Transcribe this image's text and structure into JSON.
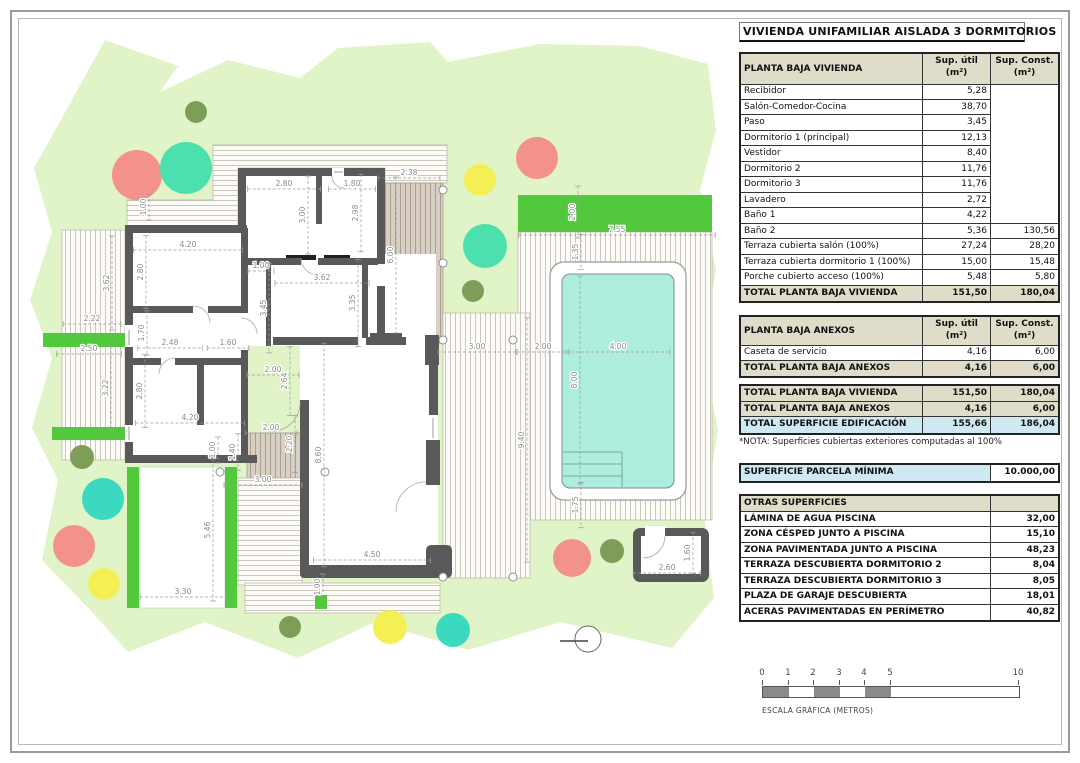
{
  "title": "VIVIENDA UNIFAMILIAR AISLADA 3 DORMITORIOS",
  "columns": {
    "util": "Sup. útil\n(m²)",
    "const": "Sup. Const.\n(m²)"
  },
  "tables": {
    "vivienda": {
      "header": "PLANTA BAJA VIVIENDA",
      "rows": [
        {
          "label": "Recibidor",
          "util": "5,28",
          "const": ""
        },
        {
          "label": "Salón-Comedor-Cocina",
          "util": "38,70",
          "const": ""
        },
        {
          "label": "Paso",
          "util": "3,45",
          "const": ""
        },
        {
          "label": "Dormitorio 1 (principal)",
          "util": "12,13",
          "const": ""
        },
        {
          "label": "Vestidor",
          "util": "8,40",
          "const": ""
        },
        {
          "label": "Dormitorio 2",
          "util": "11,76",
          "const": ""
        },
        {
          "label": "Dormitorio 3",
          "util": "11,76",
          "const": ""
        },
        {
          "label": "Lavadero",
          "util": "2,72",
          "const": ""
        },
        {
          "label": "Baño 1",
          "util": "4,22",
          "const": ""
        },
        {
          "label": "Baño 2",
          "util": "5,36",
          "const": "130,56"
        },
        {
          "label": "Terraza cubierta salón (100%)",
          "util": "27,24",
          "const": "28,20"
        },
        {
          "label": "Terraza cubierta dormitorio 1 (100%)",
          "util": "15,00",
          "const": "15,48"
        },
        {
          "label": "Porche cubierto acceso (100%)",
          "util": "5,48",
          "const": "5,80"
        },
        {
          "label": "TOTAL PLANTA BAJA VIVIENDA",
          "util": "151,50",
          "const": "180,04",
          "total": true
        }
      ]
    },
    "anexos": {
      "header": "PLANTA BAJA ANEXOS",
      "rows": [
        {
          "label": "Caseta de servicio",
          "util": "4,16",
          "const": "6,00"
        },
        {
          "label": "TOTAL PLANTA BAJA ANEXOS",
          "util": "4,16",
          "const": "6,00",
          "total": true
        }
      ]
    },
    "resumen": {
      "rows": [
        {
          "label": "TOTAL PLANTA BAJA VIVIENDA",
          "util": "151,50",
          "const": "180,04",
          "total": true
        },
        {
          "label": "TOTAL PLANTA BAJA ANEXOS",
          "util": "4,16",
          "const": "6,00",
          "total": true
        },
        {
          "label": "TOTAL SUPERFICIE EDIFICACIÓN",
          "util": "155,66",
          "const": "186,04",
          "total": true,
          "highlight": true
        }
      ]
    },
    "nota": "*NOTA: Superficies cubiertas exteriores computadas al 100%",
    "parcela": {
      "label": "SUPERFICIE PARCELA MÍNIMA",
      "value": "10.000,00"
    },
    "otras": {
      "header": "OTRAS SUPERFICIES",
      "rows": [
        {
          "label": "LÁMINA DE AGUA PISCINA",
          "value": "32,00"
        },
        {
          "label": "ZONA CÉSPED JUNTO A PISCINA",
          "value": "15,10"
        },
        {
          "label": "ZONA PAVIMENTADA JUNTO A PISCINA",
          "value": "48,23"
        },
        {
          "label": "TERRAZA DESCUBIERTA DORMITORIO 2",
          "value": "8,04"
        },
        {
          "label": "TERRAZA DESCUBIERTA DORMITORIO 3",
          "value": "8,05"
        },
        {
          "label": "PLAZA DE GARAJE DESCUBIERTA",
          "value": "18,01"
        },
        {
          "label": "ACERAS PAVIMENTADAS EN PERÍMETRO",
          "value": "40,82"
        }
      ]
    }
  },
  "scale": {
    "ticks": [
      0,
      1,
      2,
      3,
      4,
      5,
      10
    ],
    "filled_segments": [
      [
        0,
        1
      ],
      [
        2,
        3
      ],
      [
        4,
        5
      ]
    ],
    "open_segments": [
      [
        1,
        2
      ],
      [
        3,
        4
      ],
      [
        5,
        10
      ]
    ],
    "px_per_m": 25.6,
    "caption": "ESCALA GRÁFICA (METROS)",
    "fill_color": "#8a8a8a"
  },
  "plan": {
    "px_per_m": 26,
    "colors": {
      "lawn": "#e0f4c7",
      "hedge": "#52c93c",
      "wall": "#595959",
      "pool_water": "#aeeede",
      "pool_coping": "#ffffff",
      "dim_text": "#8a8a8a",
      "tree_salmon": "#f2928b",
      "tree_turquoise": "#4ce0ae",
      "tree_yellow": "#f3ef55",
      "tree_olive": "#7e9e58",
      "tree_teal": "#3bd9c0"
    },
    "dimensions": [
      {
        "t": "2.80",
        "x": 284,
        "y": 186
      },
      {
        "t": "1.80",
        "x": 352,
        "y": 186
      },
      {
        "t": "2.38",
        "x": 409,
        "y": 175
      },
      {
        "t": "4.20",
        "x": 188,
        "y": 247
      },
      {
        "t": "1.00",
        "x": 261,
        "y": 268
      },
      {
        "t": "3.62",
        "x": 322,
        "y": 280
      },
      {
        "t": "2.22",
        "x": 92,
        "y": 321
      },
      {
        "t": "2.50",
        "x": 89,
        "y": 351
      },
      {
        "t": "2.48",
        "x": 170,
        "y": 345
      },
      {
        "t": "1.60",
        "x": 228,
        "y": 345
      },
      {
        "t": "2.00",
        "x": 273,
        "y": 372
      },
      {
        "t": "2.00",
        "x": 271,
        "y": 430
      },
      {
        "t": "3.00",
        "x": 263,
        "y": 482
      },
      {
        "t": "4.20",
        "x": 190,
        "y": 420
      },
      {
        "t": "4.50",
        "x": 372,
        "y": 557
      },
      {
        "t": "3.30",
        "x": 183,
        "y": 594
      },
      {
        "t": "7.55",
        "x": 617,
        "y": 232
      },
      {
        "t": "4.00",
        "x": 618,
        "y": 349
      },
      {
        "t": "3.00",
        "x": 477,
        "y": 349
      },
      {
        "t": "2.00",
        "x": 543,
        "y": 349
      },
      {
        "t": "2.60",
        "x": 667,
        "y": 570
      },
      {
        "t": "1.00",
        "x": 146,
        "y": 207,
        "v": 1
      },
      {
        "t": "2.80",
        "x": 143,
        "y": 272,
        "v": 1
      },
      {
        "t": "1.70",
        "x": 144,
        "y": 333,
        "v": 1
      },
      {
        "t": "2.80",
        "x": 142,
        "y": 391,
        "v": 1
      },
      {
        "t": "3.62",
        "x": 109,
        "y": 283,
        "v": 1
      },
      {
        "t": "3.22",
        "x": 108,
        "y": 388,
        "v": 1
      },
      {
        "t": "3.00",
        "x": 305,
        "y": 215,
        "v": 1
      },
      {
        "t": "2.98",
        "x": 358,
        "y": 213,
        "v": 1
      },
      {
        "t": "3.45",
        "x": 266,
        "y": 308,
        "v": 1
      },
      {
        "t": "3.35",
        "x": 355,
        "y": 303,
        "v": 1
      },
      {
        "t": "6.00",
        "x": 393,
        "y": 255,
        "v": 1
      },
      {
        "t": "8.60",
        "x": 321,
        "y": 455,
        "v": 1
      },
      {
        "t": "2.64",
        "x": 287,
        "y": 381,
        "v": 1
      },
      {
        "t": "2.20",
        "x": 292,
        "y": 444,
        "v": 1
      },
      {
        "t": "1.40",
        "x": 235,
        "y": 452,
        "v": 1
      },
      {
        "t": "1.00",
        "x": 215,
        "y": 450,
        "v": 1
      },
      {
        "t": "5.46",
        "x": 210,
        "y": 530,
        "v": 1
      },
      {
        "t": "1.00",
        "x": 320,
        "y": 587,
        "v": 1
      },
      {
        "t": "2.00",
        "x": 575,
        "y": 212,
        "v": 1
      },
      {
        "t": "1.35",
        "x": 578,
        "y": 252,
        "v": 1
      },
      {
        "t": "8.00",
        "x": 577,
        "y": 380,
        "v": 1
      },
      {
        "t": "1.75",
        "x": 578,
        "y": 505,
        "v": 1
      },
      {
        "t": "9.40",
        "x": 524,
        "y": 440,
        "v": 1
      },
      {
        "t": "1.60",
        "x": 690,
        "y": 553,
        "v": 1
      }
    ],
    "trees": [
      {
        "cx": 137,
        "cy": 175,
        "r": 25,
        "c": "tree_salmon"
      },
      {
        "cx": 186,
        "cy": 168,
        "r": 26,
        "c": "tree_turquoise"
      },
      {
        "cx": 196,
        "cy": 112,
        "r": 11,
        "c": "tree_olive"
      },
      {
        "cx": 537,
        "cy": 158,
        "r": 21,
        "c": "tree_salmon"
      },
      {
        "cx": 480,
        "cy": 180,
        "r": 16,
        "c": "tree_yellow"
      },
      {
        "cx": 485,
        "cy": 246,
        "r": 22,
        "c": "tree_turquoise"
      },
      {
        "cx": 473,
        "cy": 291,
        "r": 11,
        "c": "tree_olive"
      },
      {
        "cx": 82,
        "cy": 457,
        "r": 12,
        "c": "tree_olive"
      },
      {
        "cx": 103,
        "cy": 499,
        "r": 21,
        "c": "tree_teal"
      },
      {
        "cx": 74,
        "cy": 546,
        "r": 21,
        "c": "tree_salmon"
      },
      {
        "cx": 104,
        "cy": 584,
        "r": 16,
        "c": "tree_yellow"
      },
      {
        "cx": 290,
        "cy": 627,
        "r": 11,
        "c": "tree_olive"
      },
      {
        "cx": 390,
        "cy": 627,
        "r": 17,
        "c": "tree_yellow"
      },
      {
        "cx": 453,
        "cy": 630,
        "r": 17,
        "c": "tree_teal"
      },
      {
        "cx": 572,
        "cy": 558,
        "r": 19,
        "c": "tree_salmon"
      },
      {
        "cx": 612,
        "cy": 551,
        "r": 12,
        "c": "tree_olive"
      }
    ],
    "posts": [
      [
        443,
        190
      ],
      [
        443,
        263
      ],
      [
        443,
        340
      ],
      [
        513,
        340
      ],
      [
        220,
        472
      ],
      [
        325,
        472
      ],
      [
        443,
        577
      ],
      [
        513,
        577
      ]
    ]
  }
}
